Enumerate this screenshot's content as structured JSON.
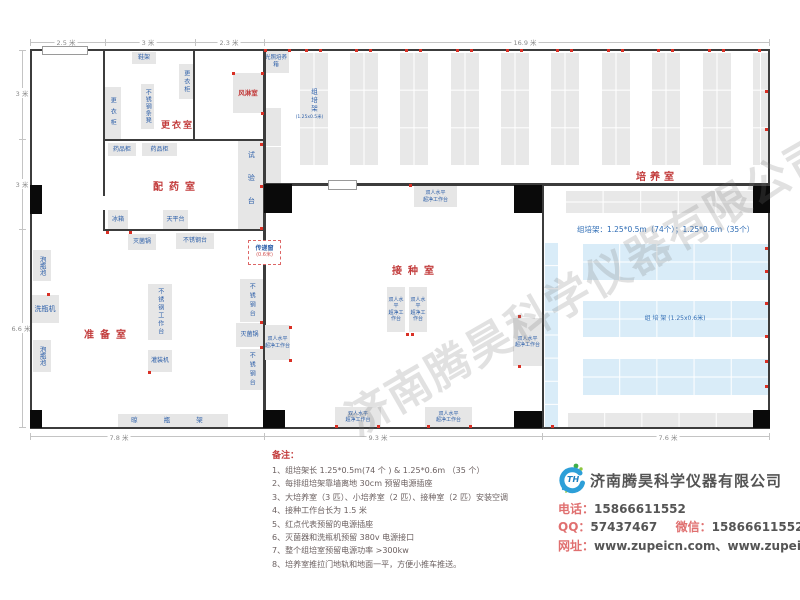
{
  "plan": {
    "rooms": {
      "dressing": "更衣室",
      "airshower": "风淋室",
      "pharmacy": "配药室",
      "prep": "准备室",
      "inoculation": "接种室",
      "culture": "培养室"
    },
    "furniture": {
      "shoe_rack": "鞋架",
      "locker_l": "更衣柜",
      "locker_r": "更衣柜",
      "steel_bench": "不锈钢条凳",
      "incubator": "光照培养箱",
      "med_cab1": "药品柜",
      "med_cab2": "药品柜",
      "test_bench": "试验台",
      "fridge": "冰箱",
      "balance": "天平台",
      "sterilizer1": "灭菌锅",
      "sterilizer2": "灭菌锅",
      "ss_table1": "不锈钢台",
      "ss_table2": "不锈钢台",
      "ss_table3": "不锈钢台",
      "soak1": "泡瓶池",
      "soak2": "泡瓶池",
      "washer": "洗瓶机",
      "workbench": "不锈钢工作台",
      "filler": "灌装机",
      "drying_rack": "晾 瓶 架",
      "cb1": "双人水平",
      "cb2": "超净工作台"
    },
    "racks": {
      "v_name": "组培架",
      "v_size": "(1.25x0.5米)",
      "h_label": "组  培  架 (1.25x0.6米)",
      "annotation": "组培架：1.25*0.5m（74个）；1.25*0.6m（35个）"
    },
    "pass_window": {
      "name": "传递窗",
      "size": "(0.6米)"
    },
    "dims": {
      "top": [
        "2.5 米",
        "3 米",
        "2.3 米",
        "16.9 米"
      ],
      "left": [
        "3 米",
        "3 米",
        "6.6 米"
      ],
      "bottom": [
        "7.8 米",
        "9.3 米",
        "7.6 米"
      ]
    }
  },
  "watermark": "济南腾昊科学仪器有限公司",
  "notes": {
    "title": "备注：",
    "items": [
      "1、组培架长 1.25*0.5m(74 个 ) & 1.25*0.6m （35 个）",
      "2、每排组培架靠墙离地 30cm 预留电源插座",
      "3、大培养室（3 匹）、小培养室（2 匹）、接种室（2 匹）安装空调",
      "4、接种工作台长为 1.5 米",
      "5、红点代表预留的电源插座",
      "6、灭菌器和洗瓶机预留 380v 电源接口",
      "7、整个组培室预留电源功率 >300kw",
      "8、培养室推拉门地轨和地面一平，方便小推车推送。"
    ]
  },
  "contact": {
    "company": "济南腾昊科学仪器有限公司",
    "phone_label": "电话：",
    "phone": "15866611552",
    "qq_label": "QQ：",
    "qq": "57437467",
    "wechat_label": "微信：",
    "wechat": "15866611552",
    "web_label": "网址：",
    "web": "www.zupeicn.com、www.zupei17.com"
  }
}
